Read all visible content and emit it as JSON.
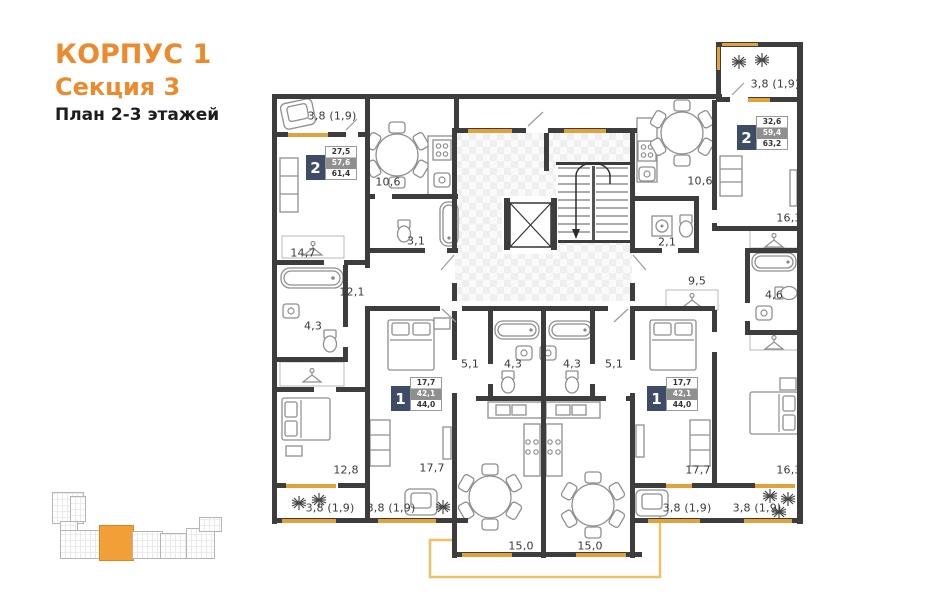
{
  "title": {
    "building": "КОРПУС 1",
    "section": "Секция 3",
    "plan": "План 2-3 этажей"
  },
  "colors": {
    "accent_orange": "#ec8a2e",
    "window_orange": "#e2a23b",
    "wall_color": "#3d3d3d",
    "badge_navy": "#3e4c66",
    "badge_gray": "#8f8f8f",
    "minimap_highlight": "#f29f38"
  },
  "plan": {
    "rooms": [
      {
        "label": "3,8 (1,9)",
        "x": 332,
        "y": 116
      },
      {
        "label": "10,6",
        "x": 388,
        "y": 182
      },
      {
        "label": "3,1",
        "x": 416,
        "y": 241
      },
      {
        "label": "14,7",
        "x": 303,
        "y": 253
      },
      {
        "label": "12,1",
        "x": 352,
        "y": 292
      },
      {
        "label": "4,3",
        "x": 313,
        "y": 326
      },
      {
        "label": "12,8",
        "x": 346,
        "y": 470
      },
      {
        "label": "3,8 (1,9)",
        "x": 330,
        "y": 508
      },
      {
        "label": "17,7",
        "x": 432,
        "y": 468
      },
      {
        "label": "3,8 (1,9)",
        "x": 391,
        "y": 508
      },
      {
        "label": "5,1",
        "x": 470,
        "y": 364
      },
      {
        "label": "4,3",
        "x": 513,
        "y": 364
      },
      {
        "label": "15,0",
        "x": 521,
        "y": 546
      },
      {
        "label": "4,3",
        "x": 572,
        "y": 364
      },
      {
        "label": "5,1",
        "x": 614,
        "y": 364
      },
      {
        "label": "15,0",
        "x": 590,
        "y": 546
      },
      {
        "label": "17,7",
        "x": 698,
        "y": 470
      },
      {
        "label": "3,8 (1,9)",
        "x": 687,
        "y": 508
      },
      {
        "label": "16,3",
        "x": 789,
        "y": 470
      },
      {
        "label": "3,8 (1,9)",
        "x": 757,
        "y": 508
      },
      {
        "label": "10,6",
        "x": 700,
        "y": 181
      },
      {
        "label": "2,1",
        "x": 667,
        "y": 242
      },
      {
        "label": "9,5",
        "x": 697,
        "y": 281
      },
      {
        "label": "16,3",
        "x": 789,
        "y": 218
      },
      {
        "label": "4,6",
        "x": 774,
        "y": 295
      },
      {
        "label": "3,8 (1,9)",
        "x": 775,
        "y": 84
      }
    ],
    "badges": [
      {
        "rooms": "2",
        "values": [
          "27,5",
          "57,6",
          "61,4"
        ],
        "x": 306,
        "y": 146
      },
      {
        "rooms": "2",
        "values": [
          "32,6",
          "59,4",
          "63,2"
        ],
        "x": 737,
        "y": 116
      },
      {
        "rooms": "1",
        "values": [
          "17,7",
          "42,1",
          "44,0"
        ],
        "x": 391,
        "y": 377
      },
      {
        "rooms": "1",
        "values": [
          "17,7",
          "42,1",
          "44,0"
        ],
        "x": 647,
        "y": 377
      }
    ]
  },
  "minimap": {
    "blocks": [
      {
        "x": 52,
        "y": 492,
        "w": 30,
        "h": 30,
        "hl": false
      },
      {
        "x": 70,
        "y": 496,
        "w": 14,
        "h": 24,
        "hl": false
      },
      {
        "x": 60,
        "y": 521,
        "w": 16,
        "h": 9,
        "hl": false
      },
      {
        "x": 60,
        "y": 530,
        "w": 40,
        "h": 27,
        "hl": false
      },
      {
        "x": 99,
        "y": 525,
        "w": 33,
        "h": 34,
        "hl": true
      },
      {
        "x": 132,
        "y": 531,
        "w": 29,
        "h": 26,
        "hl": false
      },
      {
        "x": 160,
        "y": 533,
        "w": 27,
        "h": 24,
        "hl": false
      },
      {
        "x": 186,
        "y": 528,
        "w": 27,
        "h": 29,
        "hl": false
      },
      {
        "x": 199,
        "y": 517,
        "w": 21,
        "h": 13,
        "hl": false
      }
    ]
  }
}
